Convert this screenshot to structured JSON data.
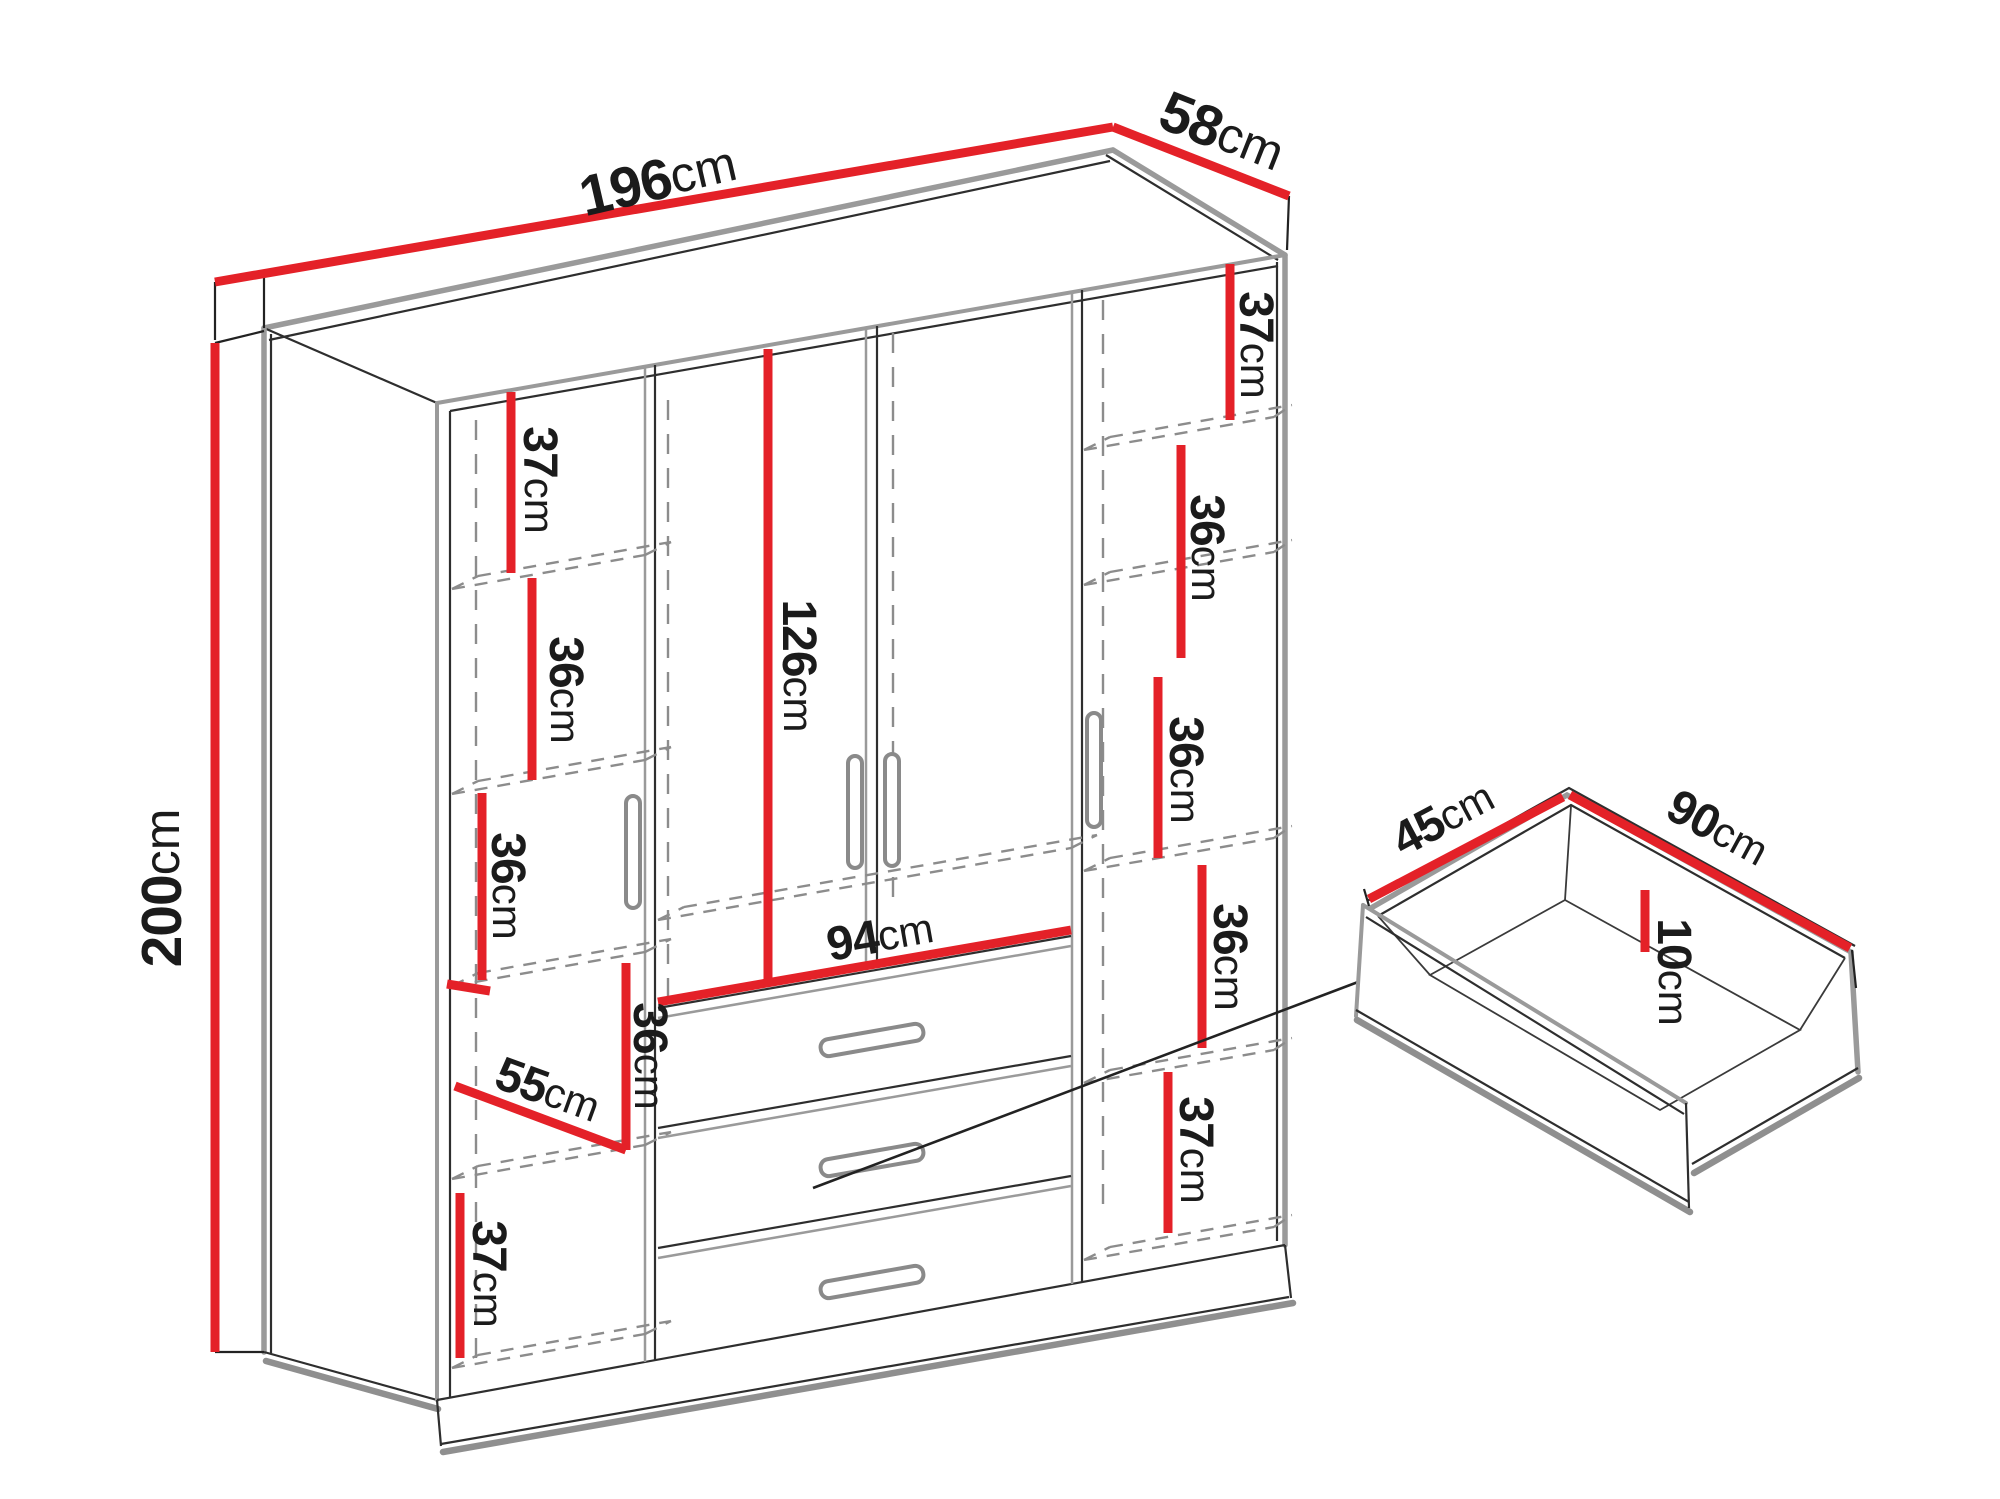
{
  "meta": {
    "title": "Wardrobe dimensions diagram"
  },
  "colors": {
    "dimension_red": "#e42128",
    "outline_gray": "#9a9a9a",
    "line_black": "#2e2e2e",
    "text": "#1b1b1b",
    "background": "#ffffff"
  },
  "wardrobe": {
    "width": {
      "num": "196",
      "unit": "cm"
    },
    "depth": {
      "num": "58",
      "unit": "cm"
    },
    "height": {
      "num": "200",
      "unit": "cm"
    },
    "left_column": {
      "bay1": {
        "num": "37",
        "unit": "cm"
      },
      "bay2": {
        "num": "36",
        "unit": "cm"
      },
      "bay3": {
        "num": "36",
        "unit": "cm"
      },
      "bay4": {
        "num": "36",
        "unit": "cm"
      },
      "shelf_depth": {
        "num": "55",
        "unit": "cm"
      },
      "bay5": {
        "num": "37",
        "unit": "cm"
      }
    },
    "center": {
      "door_height": {
        "num": "126",
        "unit": "cm"
      },
      "drawer_width": {
        "num": "94",
        "unit": "cm"
      }
    },
    "right_column": {
      "bay1": {
        "num": "37",
        "unit": "cm"
      },
      "bay2": {
        "num": "36",
        "unit": "cm"
      },
      "bay3": {
        "num": "36",
        "unit": "cm"
      },
      "bay4": {
        "num": "36",
        "unit": "cm"
      },
      "bay5": {
        "num": "37",
        "unit": "cm"
      }
    }
  },
  "drawer_detail": {
    "depth": {
      "num": "45",
      "unit": "cm"
    },
    "width": {
      "num": "90",
      "unit": "cm"
    },
    "height": {
      "num": "10",
      "unit": "cm"
    }
  }
}
